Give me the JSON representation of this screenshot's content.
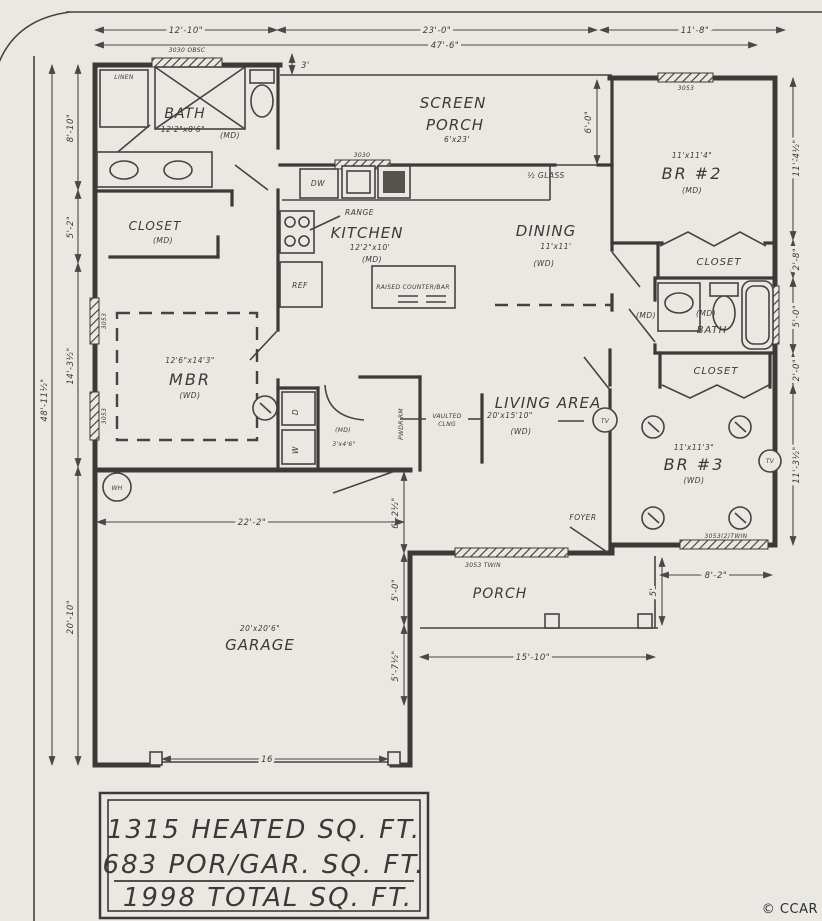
{
  "colors": {
    "paper": "#eae8e3",
    "ink": "#3c3a36",
    "credit": "#2e2e2e"
  },
  "credit": "© CCAR",
  "summary": {
    "heated": "1315 HEATED SQ. FT.",
    "porgar": "683 POR/GAR. SQ. FT.",
    "total": "1998 TOTAL SQ. FT."
  },
  "rooms": {
    "bath1": {
      "name": "BATH",
      "size": "12'2\"x8'6\"",
      "floor": "(MD)",
      "linen": "LINEN"
    },
    "closet1": {
      "name": "CLOSET",
      "floor": "(MD)"
    },
    "mbr": {
      "name": "MBR",
      "size": "12'6\"x14'3\"",
      "floor": "(WD)"
    },
    "kitchen": {
      "name": "KITCHEN",
      "size": "12'2\"x10'",
      "floor": "(MD)",
      "dw": "DW",
      "ref": "REF",
      "range": "RANGE",
      "island": "RAISED COUNTER/BAR"
    },
    "screen_porch": {
      "line1": "SCREEN",
      "line2": "PORCH",
      "size": "6'x23'"
    },
    "dining": {
      "name": "DINING",
      "size": "11'x11'",
      "floor": "(WD)",
      "door": "½ GLASS"
    },
    "br2": {
      "name": "BR #2",
      "size": "11'x11'4\"",
      "floor": "(MD)"
    },
    "closet2": {
      "name": "CLOSET"
    },
    "bath2": {
      "name": "BATH",
      "floor": "(MD)",
      "hall_floor": "(MD)"
    },
    "closet3": {
      "name": "CLOSET"
    },
    "br3": {
      "name": "BR #3",
      "size": "11'x11'3\"",
      "floor": "(WD)",
      "tv": "TV"
    },
    "living": {
      "name": "LIVING AREA",
      "size": "20'x15'10\"",
      "floor": "(WD)",
      "vaulted1": "VAULTED",
      "vaulted2": "CLNG",
      "tv": "TV",
      "foyer": "FOYER"
    },
    "laundry": {
      "washer": "W",
      "dryer": "D",
      "powder": "PWDR RM",
      "hall_size": "3'x4'6\"",
      "hall_floor": "(MD)"
    },
    "garage": {
      "name": "GARAGE",
      "size": "20'x20'6\"",
      "wh": "WH"
    },
    "porch": {
      "name": "PORCH"
    }
  },
  "windows": {
    "bath1": "3030 OBSC",
    "kitchen": "3030",
    "br2": "3053",
    "living": "3053 TWIN",
    "br3": "3053(2)TWIN",
    "mbr1": "3053",
    "mbr2": "3053"
  },
  "dims": {
    "top": {
      "d12_10": "12'-10\"",
      "d23_0": "23'-0\"",
      "d47_6": "47'-6\"",
      "d11_8": "11'-8\"",
      "d3": "3'"
    },
    "left": {
      "d8_10": "8'-10\"",
      "d5_2": "5'-2\"",
      "d14_3": "14'-3½\"",
      "d48_11": "48'-11½\"",
      "d20_10": "20'-10\""
    },
    "right": {
      "d11_4": "11'-4½\"",
      "d2_8": "2'-8\"",
      "d5_0": "5'-0\"",
      "d2_0": "2'-0\"",
      "d11_3": "11'-3½\"",
      "d8_2": "8'-2\"",
      "d5": "5'"
    },
    "mid": {
      "d6_0": "6'-0\"",
      "d6_2": "6'-2½\"",
      "d5_0b": "5'-0\"",
      "d5_7": "5'-7½\"",
      "d22_2": "22'-2\"",
      "d16": "16",
      "d15_10": "15'-10\""
    }
  }
}
